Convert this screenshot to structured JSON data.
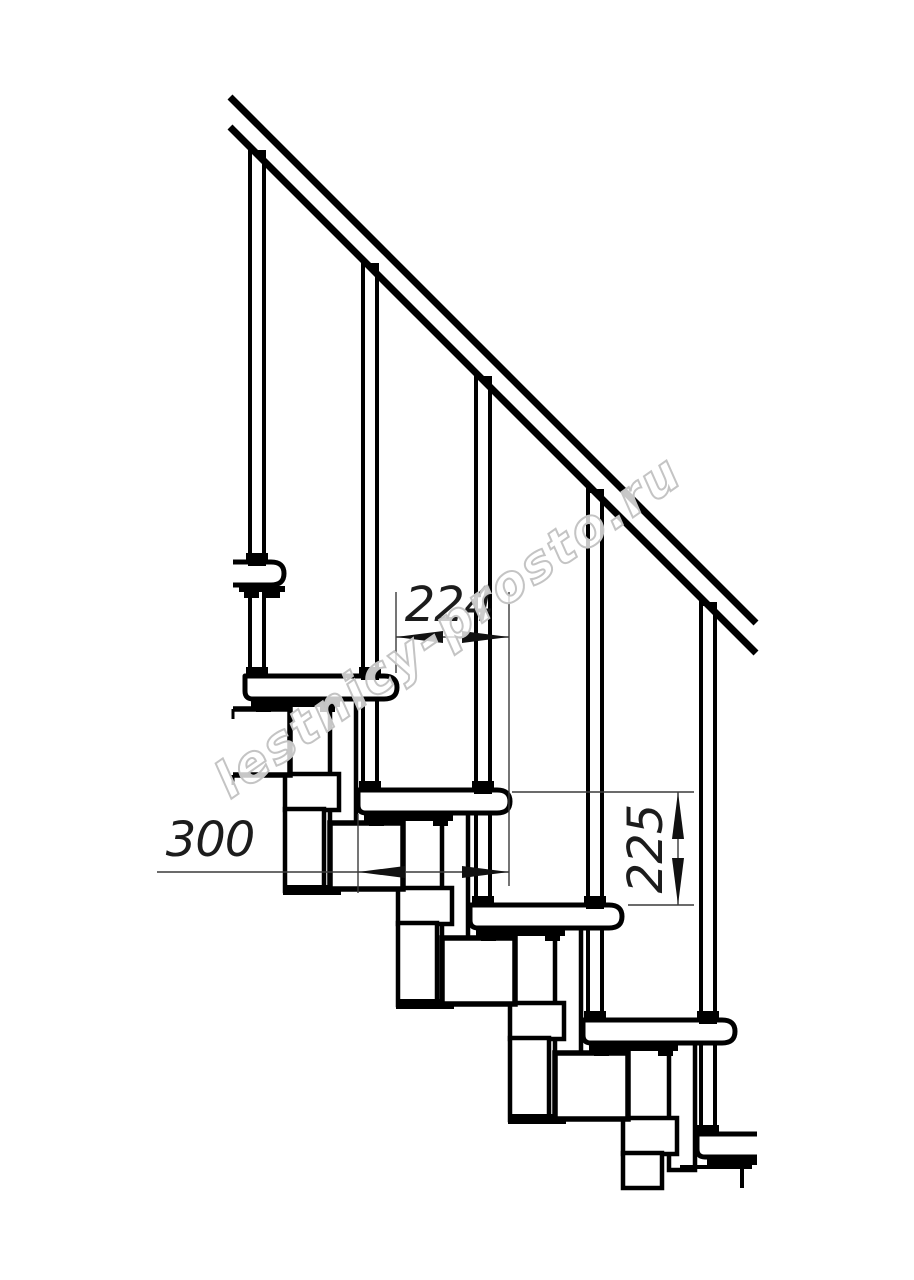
{
  "watermark": {
    "text": "lestnicy-prosto.ru",
    "color": "#c4c4c4"
  },
  "dimensions": {
    "horizontal_span": {
      "value": "224"
    },
    "tread_depth": {
      "value": "300"
    },
    "riser_height": {
      "value": "225"
    }
  },
  "drawing": {
    "subject": "modular staircase side elevation",
    "style": "black technical line drawing on white",
    "visible_treads": 6,
    "visible_handrail_posts": 5,
    "line_color": "#000000",
    "background_color": "#ffffff",
    "dimension_text_color": "#1c1c1c"
  }
}
